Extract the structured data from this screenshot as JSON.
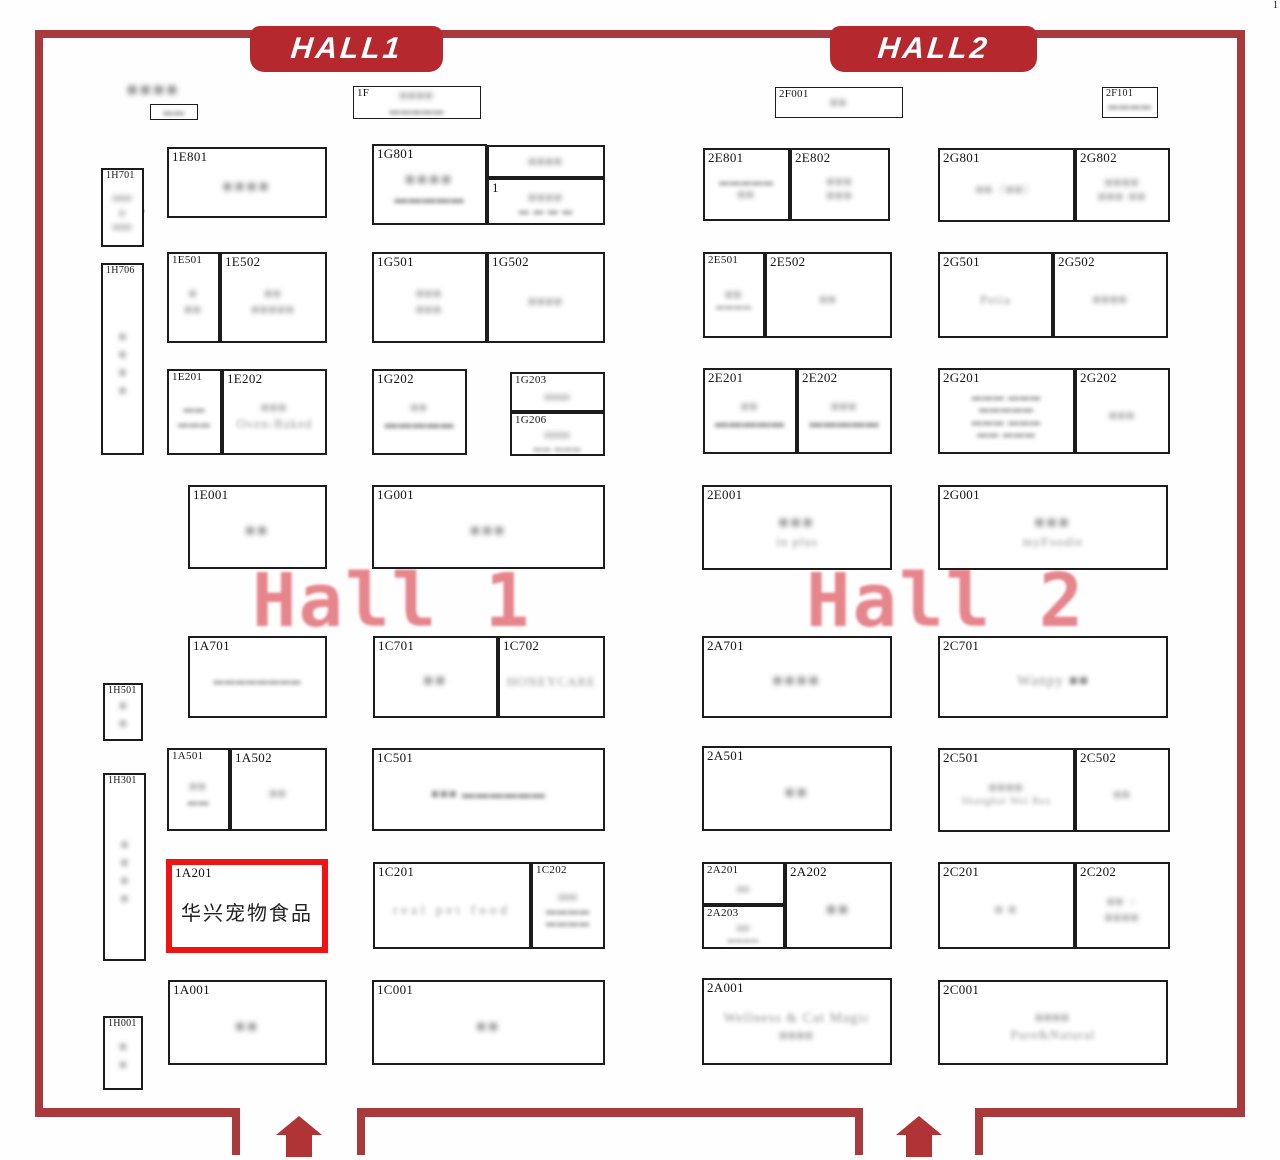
{
  "header": {
    "hall1_banner": "HALL1",
    "hall2_banner": "HALL2"
  },
  "watermarks": {
    "hall1": "Hall 1",
    "hall2": "Hall 2"
  },
  "annotations": {
    "count_label": "9",
    "corner_mark": "1"
  },
  "colors": {
    "wall": "#a83a3d",
    "banner": "#b5282e",
    "highlight_border": "#ec1414",
    "watermark": "#e06770"
  },
  "highlight_booth": {
    "code": "1A201",
    "name": "华兴宠物食品"
  },
  "booths": {
    "topleft": {
      "l1": "■■■■",
      "l2": "▬▬"
    },
    "f1": {
      "c": "1F",
      "l1": "■■■■",
      "l2": "▬▬▬▬▬"
    },
    "2F001": {
      "c": "2F001",
      "l1": "■■",
      "l2": "▬▬▬▬"
    },
    "2F101": {
      "c": "2F101",
      "l1": "▬▬▬▬"
    },
    "1H701": {
      "c": "1H701",
      "l1": "■■■",
      "l2": "■",
      "l3": "■■■"
    },
    "1H706": {
      "c": "1H706",
      "l1": "■■■■"
    },
    "1H501": {
      "c": "1H501",
      "l1": "■■"
    },
    "1H301": {
      "c": "1H301",
      "l1": "■■■■"
    },
    "1H001": {
      "c": "1H001",
      "l1": "■■"
    },
    "1E801": {
      "c": "1E801",
      "l1": "■■■■"
    },
    "1G801": {
      "c": "1G801",
      "l1": "■■■■",
      "l2": "▬▬▬▬▬"
    },
    "stacktop": {
      "l1": "■■■■"
    },
    "stackbottom": {
      "c": "1",
      "l1": "■■■■",
      "l2": "▬ ▬ ▬ ▬"
    },
    "1E501": {
      "c": "1E501",
      "l1": "■",
      "l2": "■■"
    },
    "1E502": {
      "c": "1E502",
      "l1": "■■",
      "l2": "■■■■■"
    },
    "1G501": {
      "c": "1G501",
      "l1": "■■■",
      "l2": "■■■"
    },
    "1G502": {
      "c": "1G502",
      "l1": "■■■■"
    },
    "1E201": {
      "c": "1E201",
      "l1": "▬▬",
      "l2": "▬▬▬"
    },
    "1E202": {
      "c": "1E202",
      "l1": "■■■",
      "l2": "Oven-Baked"
    },
    "1G202": {
      "c": "1G202",
      "l1": "■■",
      "l2": "▬▬▬▬▬"
    },
    "1G203": {
      "c": "1G203",
      "l1": "■■■■"
    },
    "1G206": {
      "c": "1G206",
      "l1": "■■■■",
      "l2": "▬▬ ▬▬▬"
    },
    "1E001": {
      "c": "1E001",
      "l1": "■■"
    },
    "1G001": {
      "c": "1G001",
      "l1": "■■■"
    },
    "1A701": {
      "c": "1A701",
      "l1": "▬▬▬▬▬▬▬▬"
    },
    "1C701": {
      "c": "1C701",
      "l1": "■■"
    },
    "1C702": {
      "c": "1C702",
      "l1": "HONEYCARE"
    },
    "1A501": {
      "c": "1A501",
      "l1": "■■",
      "l2": "▬▬"
    },
    "1A502": {
      "c": "1A502",
      "l1": "■■"
    },
    "1C501": {
      "c": "1C501",
      "l1": "■■■ ▬▬▬▬▬▬"
    },
    "1A201": {
      "c": "1A201",
      "name": "华兴宠物食品"
    },
    "1C201": {
      "c": "1C201",
      "l1": "real pet food"
    },
    "1C202": {
      "c": "1C202",
      "l1": "■■■",
      "l2": "▬▬▬▬",
      "l3": "▬▬▬▬"
    },
    "1A001": {
      "c": "1A001",
      "l1": "■■"
    },
    "1C001": {
      "c": "1C001",
      "l1": "■■"
    },
    "2E801": {
      "c": "2E801",
      "l1": "▬▬▬▬▬",
      "l2": "■■"
    },
    "2E802": {
      "c": "2E802",
      "l1": "■■■",
      "l2": "■■■"
    },
    "2G801": {
      "c": "2G801",
      "l1": "■■（■■）"
    },
    "2G802": {
      "c": "2G802",
      "l1": "■■■■",
      "l2": "■■■ ■■"
    },
    "2E501": {
      "c": "2E501",
      "l1": "■■",
      "l2": "▬▬▬▬"
    },
    "2E502": {
      "c": "2E502",
      "l1": "■■"
    },
    "2G501": {
      "c": "2G501",
      "l1": "Petia"
    },
    "2G502": {
      "c": "2G502",
      "l1": "■■■■"
    },
    "2E201": {
      "c": "2E201",
      "l1": "■■",
      "l2": "▬▬▬▬▬"
    },
    "2E202": {
      "c": "2E202",
      "l1": "■■■",
      "l2": "▬▬▬▬▬"
    },
    "2G201": {
      "c": "2G201",
      "l1": "▬▬▬ ▬▬▬",
      "l2": "▬▬▬▬▬",
      "l3": "▬▬▬ ▬▬▬",
      "l4": "▬▬ ▬▬▬"
    },
    "2G202": {
      "c": "2G202",
      "l1": "■■■"
    },
    "2E001": {
      "c": "2E001",
      "l1": "■■■",
      "l2": "in plus"
    },
    "2G001": {
      "c": "2G001",
      "l1": "■■■",
      "l2": "myFoodie"
    },
    "2A701": {
      "c": "2A701",
      "l1": "■■■■"
    },
    "2C701": {
      "c": "2C701",
      "l1": "Wanpy ■■"
    },
    "2A501": {
      "c": "2A501",
      "l1": "■■"
    },
    "2C501": {
      "c": "2C501",
      "l1": "■■■■",
      "l2": "Shanghai Wei Rex"
    },
    "2C502": {
      "c": "2C502",
      "l1": "■■"
    },
    "2A201": {
      "c": "2A201",
      "l1": "■■"
    },
    "2A202": {
      "c": "2A202",
      "l1": "■■"
    },
    "2A203": {
      "c": "2A203",
      "l1": "■■",
      "l2": "▬▬▬▬"
    },
    "2C201": {
      "c": "2C201",
      "l1": "■ ■"
    },
    "2C202": {
      "c": "2C202",
      "l1": "■■ +",
      "l2": "■■■■"
    },
    "2A001": {
      "c": "2A001",
      "l1": "Wellness & Cat Magic",
      "l2": "■■■■"
    },
    "2C001": {
      "c": "2C001",
      "l1": "■■■■",
      "l2": "Pure&Natural"
    }
  }
}
